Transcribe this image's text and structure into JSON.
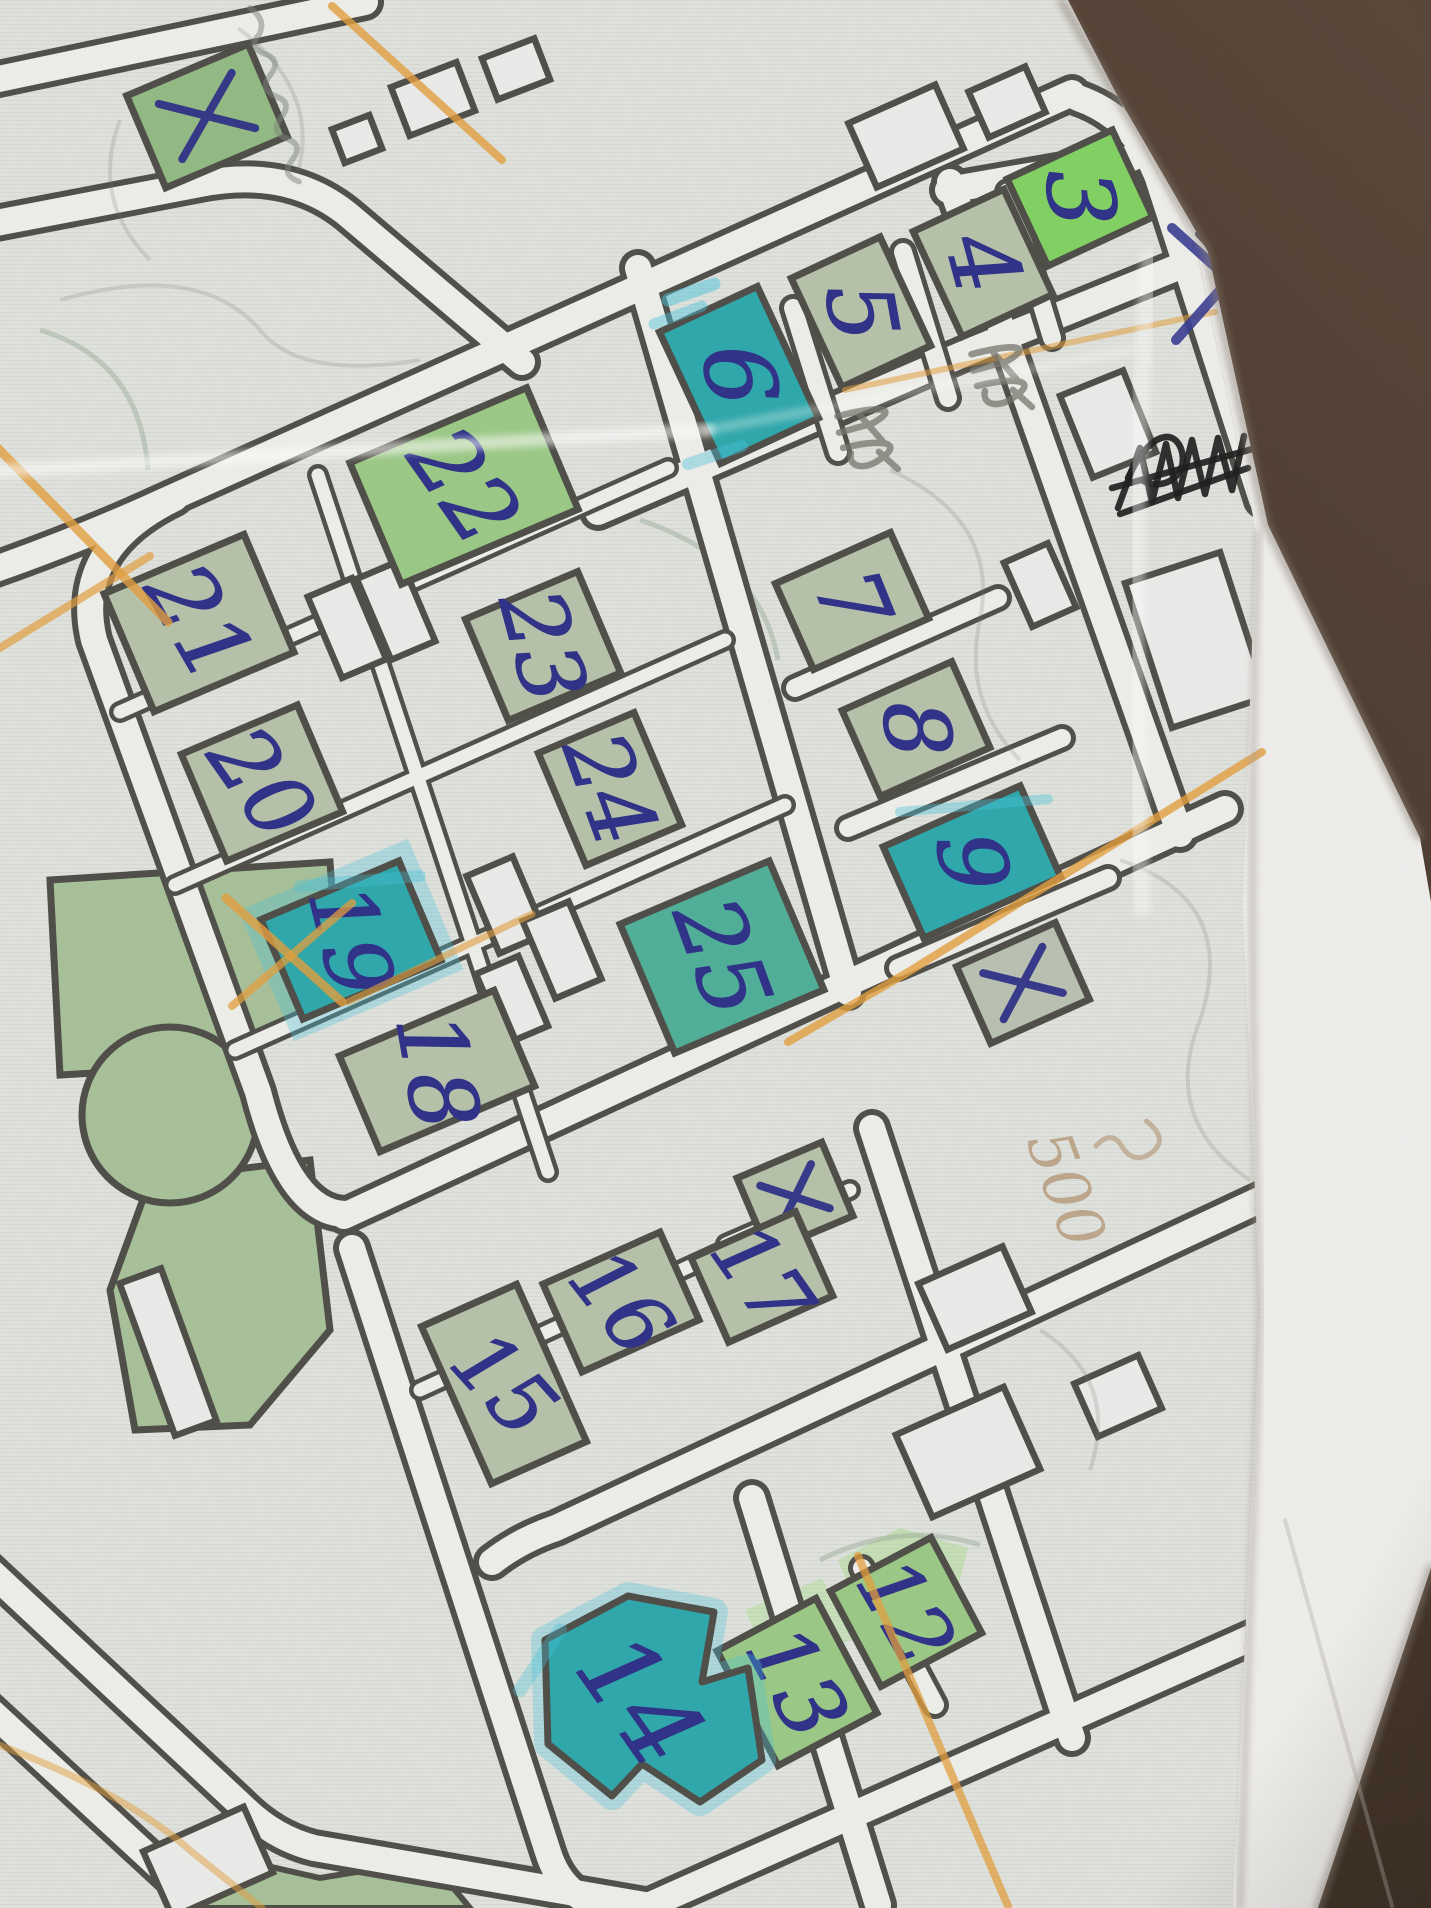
{
  "scene": {
    "background_top": "#5a473a",
    "background_bottom": "#33271d",
    "paper": "#efeeec",
    "print_bg": "#e1e3de",
    "street_line": "#504f49",
    "street_fill": "#eeeeea",
    "outline": "#4f4e48",
    "ink": "#2f3288",
    "orange": "#e39f3e",
    "cyan": "#49c3da",
    "pencil": "#75756d",
    "black_ink": "#1f1f1f",
    "park_green": "#a8c19a",
    "wash_green": "#abdc92"
  },
  "fills": {
    "pale": "#b7c2aa",
    "green": "#93ba85",
    "green2": "#9cc986",
    "bright": "#82d163",
    "teal": "#2fa8ac",
    "tealgreen": "#50af99",
    "palegray": "#bac1b2",
    "white": "#ebecea"
  },
  "paper_polygon": "0,0 1062,0 1208,252 1268,525 1420,838 1431,902 1431,1568 1318,1908 0,1908",
  "print_polygon": "0,0 1068,0 1196,248 1256,530 1243,905 1260,1310 1233,1908 0,1908",
  "streets": {
    "main": [
      "M -30,85 L 365,2",
      "M -30,228 L 200,184 Q 292,166 352,218 L 522,362",
      "M -30,578 Q 75,542 162,502 L 1072,93",
      "M 175,498 Q 72,548 94,640 L 258,1092 Q 290,1216 348,1214",
      "M 344,1216 L 1225,809",
      "M 352,1248 L 548,1852 Q 562,1898 608,1908",
      "M 492,1562 Q 520,1540 556,1528 L 1285,1188",
      "M 752,1498 L 878,1905",
      "M 648,1906 L 1318,1608",
      "M 872,1128 L 1072,1738",
      "M 638,268 L 848,992",
      "M 950,182 L 1180,834",
      "M 1078,98 Q 1135,118 1158,178 L 1262,500",
      "M 948,190 L 1132,158",
      "M 598,512 L 968,352 L 1235,244",
      "M -30,1552 L 242,1806 Q 274,1838 314,1848 L 662,1908",
      "M -30,1692 L 178,1884"
    ],
    "thin": [
      "M 793,308 L 838,452",
      "M 903,252 L 948,398",
      "M 1008,192 L 1052,338",
      "M 795,688 L 998,598",
      "M 848,828 L 1062,738",
      "M 898,968 L 1108,878",
      "M 862,1568 L 935,1705"
    ],
    "internal": [
      "M 318,475 L 548,1172",
      "M 120,712 L 668,468",
      "M 175,885 L 725,640",
      "M 235,1050 L 785,805",
      "M 420,1390 L 795,1218",
      "M 726,1244 L 850,1190"
    ]
  },
  "park": {
    "poly_a": "50,880 330,862 340,1000 230,1065 60,1075",
    "poly_b": "150,1180 310,1160 330,1330 250,1425 135,1430 110,1290",
    "circle": {
      "cx": 170,
      "cy": 1115,
      "r": 88
    },
    "strip": "170,1908 205,1852 320,1878 430,1860 470,1908"
  },
  "washes": [
    {
      "pts": "838,1560 900,1528 968,1548 952,1612 870,1640",
      "o": 0.5
    },
    {
      "pts": "745,1610 822,1578 852,1640 770,1666",
      "o": 0.45
    }
  ],
  "buildings": [
    {
      "label": "",
      "mark": "x",
      "x": 207,
      "y": 116,
      "w": 132,
      "h": 100,
      "rot": -23,
      "fill": "green"
    },
    {
      "label": "3",
      "x": 1080,
      "y": 198,
      "w": 116,
      "h": 96,
      "rot": -25,
      "fill": "bright",
      "nr": 85,
      "fs": 92
    },
    {
      "label": "4",
      "x": 983,
      "y": 263,
      "w": 100,
      "h": 116,
      "rot": -25,
      "fill": "pale",
      "nr": 75,
      "fs": 92
    },
    {
      "label": "5",
      "x": 861,
      "y": 312,
      "w": 98,
      "h": 120,
      "rot": -25,
      "fill": "pale",
      "nr": 80,
      "fs": 92
    },
    {
      "label": "6",
      "x": 739,
      "y": 375,
      "w": 108,
      "h": 145,
      "rot": -25,
      "fill": "teal",
      "nr": 82,
      "fs": 96
    },
    {
      "label": "7",
      "x": 852,
      "y": 601,
      "w": 126,
      "h": 94,
      "rot": -24,
      "fill": "pale",
      "nr": 68,
      "fs": 90
    },
    {
      "label": "8",
      "x": 916,
      "y": 729,
      "w": 120,
      "h": 94,
      "rot": -24,
      "fill": "pale",
      "nr": 84,
      "fs": 90
    },
    {
      "label": "9",
      "x": 972,
      "y": 862,
      "w": 150,
      "h": 100,
      "rot": -24,
      "fill": "teal",
      "nr": 80,
      "fs": 92
    },
    {
      "label": "",
      "mark": "x",
      "x": 1023,
      "y": 983,
      "w": 108,
      "h": 84,
      "rot": -24,
      "fill": "palegray"
    },
    {
      "label": "22",
      "x": 464,
      "y": 486,
      "w": 192,
      "h": 132,
      "rot": -23,
      "fill": "green2",
      "nr": 55,
      "fs": 92
    },
    {
      "label": "21",
      "x": 199,
      "y": 623,
      "w": 152,
      "h": 128,
      "rot": -23,
      "fill": "pale",
      "nr": 60,
      "fs": 92
    },
    {
      "label": "23",
      "x": 543,
      "y": 646,
      "w": 122,
      "h": 110,
      "rot": -23,
      "fill": "pale",
      "nr": 75,
      "fs": 88
    },
    {
      "label": "20",
      "x": 262,
      "y": 783,
      "w": 126,
      "h": 116,
      "rot": -23,
      "fill": "pale",
      "nr": 55,
      "fs": 88
    },
    {
      "label": "24",
      "x": 610,
      "y": 789,
      "w": 104,
      "h": 122,
      "rot": -23,
      "fill": "pale",
      "nr": 70,
      "fs": 88
    },
    {
      "label": "19",
      "x": 351,
      "y": 940,
      "w": 150,
      "h": 108,
      "rot": -23,
      "fill": "teal",
      "nr": 76,
      "fs": 88,
      "halo": true
    },
    {
      "label": "25",
      "x": 722,
      "y": 957,
      "w": 162,
      "h": 140,
      "rot": -23,
      "fill": "tealgreen",
      "nr": 70,
      "fs": 92
    },
    {
      "label": "18",
      "x": 437,
      "y": 1071,
      "w": 168,
      "h": 104,
      "rot": -23,
      "fill": "pale",
      "nr": 80,
      "fs": 92
    },
    {
      "label": "",
      "mark": "x",
      "x": 795,
      "y": 1197,
      "w": 92,
      "h": 80,
      "rot": -23,
      "fill": "pale"
    },
    {
      "label": "17",
      "x": 762,
      "y": 1277,
      "w": 114,
      "h": 92,
      "rot": -24,
      "fill": "pale",
      "nr": 55,
      "fs": 84
    },
    {
      "label": "16",
      "x": 621,
      "y": 1302,
      "w": 128,
      "h": 96,
      "rot": -24,
      "fill": "pale",
      "nr": 52,
      "fs": 84
    },
    {
      "label": "15",
      "x": 504,
      "y": 1384,
      "w": 104,
      "h": 172,
      "rot": -24,
      "fill": "pale",
      "nr": 48,
      "fs": 84
    },
    {
      "label": "12",
      "x": 906,
      "y": 1612,
      "w": 114,
      "h": 108,
      "rot": -28,
      "fill": "green2",
      "nr": 60,
      "fs": 84
    },
    {
      "label": "13",
      "x": 797,
      "y": 1682,
      "w": 112,
      "h": 130,
      "rot": -28,
      "fill": "green2",
      "nr": 62,
      "fs": 88
    },
    {
      "label": "14",
      "x": 640,
      "y": 1700,
      "rot": 0,
      "fill": "teal",
      "nr": 55,
      "fs": 104,
      "halo": true,
      "shape": "poly",
      "points": "545,1640 628,1596 714,1612 702,1682 748,1668 762,1760 700,1802 642,1764 612,1796 548,1744"
    }
  ],
  "small_buildings": [
    {
      "x": 433,
      "y": 99,
      "w": 70,
      "h": 52,
      "rot": -21
    },
    {
      "x": 516,
      "y": 69,
      "w": 56,
      "h": 44,
      "rot": -21
    },
    {
      "x": 357,
      "y": 139,
      "w": 40,
      "h": 36,
      "rot": -21
    },
    {
      "x": 906,
      "y": 136,
      "w": 95,
      "h": 70,
      "rot": -24
    },
    {
      "x": 1007,
      "y": 102,
      "w": 62,
      "h": 50,
      "rot": -24
    },
    {
      "x": 1232,
      "y": 242,
      "w": 60,
      "h": 58,
      "rot": -24,
      "f": "pale"
    },
    {
      "x": 347,
      "y": 628,
      "w": 48,
      "h": 88,
      "rot": -23
    },
    {
      "x": 396,
      "y": 610,
      "w": 48,
      "h": 88,
      "rot": -23
    },
    {
      "x": 506,
      "y": 905,
      "w": 50,
      "h": 84,
      "rot": -23
    },
    {
      "x": 562,
      "y": 950,
      "w": 50,
      "h": 84,
      "rot": -23
    },
    {
      "x": 512,
      "y": 1000,
      "w": 46,
      "h": 76,
      "rot": -23
    },
    {
      "x": 1040,
      "y": 585,
      "w": 48,
      "h": 70,
      "rot": -24
    },
    {
      "x": 1196,
      "y": 640,
      "w": 100,
      "h": 152,
      "rot": -18
    },
    {
      "x": 1108,
      "y": 424,
      "w": 68,
      "h": 88,
      "rot": -22
    },
    {
      "x": 975,
      "y": 1298,
      "w": 92,
      "h": 72,
      "rot": -24
    },
    {
      "x": 968,
      "y": 1452,
      "w": 118,
      "h": 90,
      "rot": -24
    },
    {
      "x": 1118,
      "y": 1396,
      "w": 70,
      "h": 58,
      "rot": -24
    },
    {
      "x": 168,
      "y": 1352,
      "w": 44,
      "h": 162,
      "rot": -20
    },
    {
      "x": 208,
      "y": 1862,
      "w": 110,
      "h": 72,
      "rot": -24
    }
  ],
  "annotations": {
    "cyan_strokes": [
      {
        "d": "M 668,300 L 714,284",
        "w": 13,
        "o": 0.5
      },
      {
        "d": "M 654,324 L 702,306",
        "w": 11,
        "o": 0.45
      },
      {
        "d": "M 688,464 L 742,446",
        "w": 12,
        "o": 0.4
      },
      {
        "d": "M 900,812 L 1048,799",
        "w": 10,
        "o": 0.4
      },
      {
        "d": "M 300,886 L 420,876",
        "w": 12,
        "o": 0.35
      },
      {
        "d": "M 560,1630 L 520,1690",
        "w": 14,
        "o": 0.35
      }
    ],
    "orange_lines": [
      {
        "d": "M 332,6 L 502,160",
        "w": 8,
        "o": 0.8
      },
      {
        "d": "M -20,430 L 168,622",
        "w": 9,
        "o": 0.8
      },
      {
        "d": "M -20,660 L 150,556",
        "w": 8,
        "o": 0.7
      },
      {
        "d": "M 226,898 L 342,1002",
        "w": 9,
        "o": 0.8
      },
      {
        "d": "M 352,903 L 232,1006",
        "w": 8,
        "o": 0.75
      },
      {
        "d": "M 348,1002 L 532,914",
        "w": 7,
        "o": 0.6
      },
      {
        "d": "M 1262,752 L 905,974 L 788,1042",
        "w": 8,
        "o": 0.8
      },
      {
        "d": "M 845,390 L 1215,312",
        "w": 6,
        "o": 0.55
      },
      {
        "d": "M 858,1556 L 1008,1906",
        "w": 8,
        "o": 0.75
      },
      {
        "d": "M -20,1738 Q 120,1788 192,1852 L 262,1908",
        "w": 7,
        "o": 0.5
      },
      {
        "d": "M 1160,134 L 1254,110",
        "w": 6,
        "o": 0.5
      }
    ],
    "pencil_curves": [
      "M 60,300 Q 200,260 260,330 Q 300,380 420,360",
      "M 890,470 Q 1000,520 980,620 Q 962,700 1020,760",
      "M 1120,860 Q 1240,900 1200,1020 Q 1160,1120 1250,1180",
      "M 238,28 Q 320,90 298,172",
      "M 1040,1330 Q 1120,1380 1090,1470",
      "M 120,120 Q 90,200 150,260"
    ],
    "green_curves": [
      "M 40,330 Q 140,360 148,470",
      "M 640,520 Q 760,560 778,660",
      "M 820,1560 Q 900,1520 980,1545"
    ],
    "pencil_scribbles": [
      {
        "x": 872,
        "y": 398,
        "rot": 66
      },
      {
        "x": 1006,
        "y": 336,
        "rot": 66
      }
    ],
    "pencil_scribble_path": "M 2,30 C 8,-6 16,-16 18,8 L 14,34 M 8,14 L 34,6 M 26,36 C 32,4 42,-10 46,16 C 48,30 40,38 32,32 M 40,12 L 58,4",
    "pencil_word": {
      "x": 250,
      "y": 8,
      "rot": 12,
      "path": "M 0,0 Q 14,6 10,18 Q 4,28 18,30 Q 30,32 24,44 Q 18,56 32,58 Q 44,60 38,72 Q 32,84 46,86 Q 58,88 52,100 Q 46,112 60,114"
    },
    "black_scribble": [
      "M 1118,508 L 1140,448 L 1152,502 L 1166,444 L 1178,498 L 1192,440 L 1205,494 L 1218,438 L 1232,490 L 1244,436",
      "M 1112,488 L 1256,448",
      "M 1120,514 L 1248,468",
      "M 1128,478 C 1150,430 1176,428 1182,452 C 1188,478 1160,492 1142,480"
    ],
    "blue_x": [
      {
        "d": "M 1172,228 L 1290,334",
        "c": "#3a3d92",
        "w": 10,
        "o": 0.9
      },
      {
        "d": "M 1284,218 L 1176,340",
        "c": "#3a3d92",
        "w": 10,
        "o": 0.9
      },
      {
        "d": "M 1198,234 L 1280,326",
        "c": "#23233c",
        "w": 6,
        "o": 0.85
      }
    ],
    "note": {
      "x": 1046,
      "y": 1196,
      "rot": 70,
      "text": "500",
      "squiggle": "M -36,-120 Q -10,-136 -4,-112 Q 0,-92 -22,-88 Q -40,-84 -30,-64"
    },
    "creases": [
      {
        "d": "M -20,472 L 708,430",
        "w": 13,
        "c": "#ffffff",
        "o": 0.55,
        "f": 1
      },
      {
        "d": "M 708,430 L 1130,350",
        "w": 10,
        "c": "#ffffff",
        "o": 0.3,
        "f": 1
      },
      {
        "d": "M 1150,258 Q 1126,560 1142,908",
        "w": 18,
        "c": "#ffffff",
        "o": 0.4,
        "f": 1
      },
      {
        "d": "M 1258,532 Q 1246,900 1260,1310 L 1240,1906",
        "w": 7,
        "c": "#a79f95",
        "o": 0.5,
        "f": 1
      },
      {
        "d": "M 1062,2 L 1206,250 L 1266,524 L 1419,836",
        "w": 9,
        "c": "#8a7f74",
        "o": 0.5,
        "f": 1
      },
      {
        "d": "M 1431,1568 L 1318,1908",
        "w": 9,
        "c": "#8a7f74",
        "o": 0.5,
        "f": 1
      },
      {
        "d": "M 1285,1520 L 1392,1906",
        "w": 4,
        "c": "#b5afa6",
        "o": 0.4,
        "f": 0
      }
    ]
  }
}
